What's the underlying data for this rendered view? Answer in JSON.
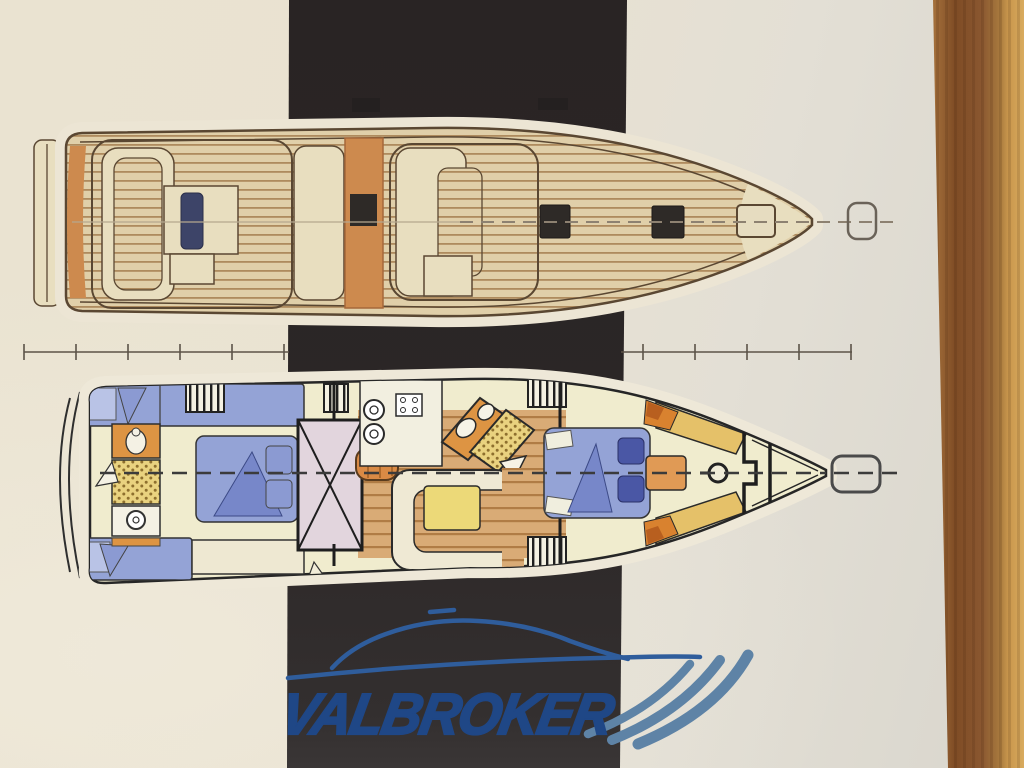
{
  "watermark": {
    "text": "VALBROKER"
  },
  "scale_ruler": {
    "left_tick_count": 6,
    "right_tick_count": 5
  },
  "colors": {
    "paper": "#e9e2d1",
    "band": "#2a2525",
    "halo": "#ece5d4",
    "outline-top": "#5a4732",
    "plank-bg": "#e0cfa9",
    "plank-line": "#ae8b5e",
    "deck-cream": "#e8debf",
    "trim-orange": "#cd8a4e",
    "hatch-black": "#2e2a27",
    "hatch-navy": "#3d4468",
    "cabin-floor": "#f0ecce",
    "berth-blue": "#94a3d6",
    "berth-blue-dark": "#7787c9",
    "navy-cushion": "#4a57a5",
    "head-orange": "#dd9443",
    "shower-yellow": "#e9d27f",
    "shower-dot": "#8d6f2e",
    "lavender": "#e2d5dd",
    "floor-wood": "#d9ab76",
    "floor-wood-line": "#b07c45",
    "table-yellow": "#ecd978",
    "locker-gold": "#e5c169",
    "cushion-orange": "#d9822f",
    "cushion-rust": "#b85f1f",
    "ruler": "#5c5348",
    "logo-blue": "#1f4786",
    "logo-line-blue": "#2f5d9c",
    "swoosh-blue": "#5e83a6",
    "wood": "#8a5a2e",
    "wood-light": "#d9ab5e"
  }
}
